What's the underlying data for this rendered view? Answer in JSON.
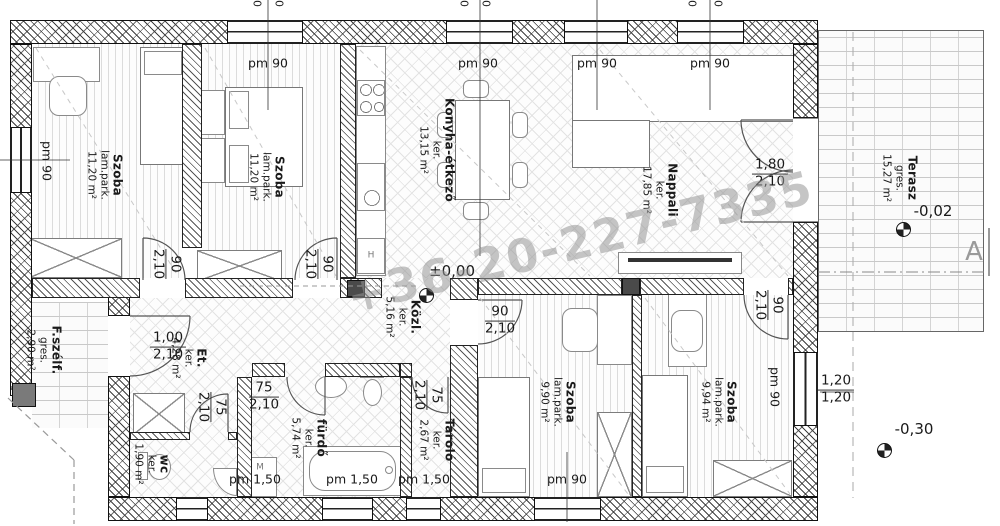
{
  "watermark": "+36-20-227-7335",
  "section": {
    "label": "A"
  },
  "levels": {
    "interior": "±0,00",
    "terrace": "-0,02",
    "garden": "-0,30"
  },
  "rooms": [
    {
      "name": "Szoba",
      "material": "lam.park.",
      "area": "11,20 m²"
    },
    {
      "name": "Szoba",
      "material": "lam.park.",
      "area": "11,20 m²"
    },
    {
      "name": "Konyha-étkező",
      "material": "ker.",
      "area": "13,15 m²"
    },
    {
      "name": "Nappali",
      "material": "ker.",
      "area": "17,85 m²"
    },
    {
      "name": "Terasz",
      "material": "gres.",
      "area": "15,27 m²"
    },
    {
      "name": "F.szélf.",
      "material": "gres.",
      "area": "2,90 m²"
    },
    {
      "name": "Et.",
      "material": "ker.",
      "area": "4,28 m²"
    },
    {
      "name": "Közl.",
      "material": "ker.",
      "area": "5,16 m²"
    },
    {
      "name": "wc",
      "material": "ker.",
      "area": "1,90 m²"
    },
    {
      "name": "fürdő",
      "material": "ker.",
      "area": "5,74 m²"
    },
    {
      "name": "Tároló",
      "material": "ker.",
      "area": "2,67 m²"
    },
    {
      "name": "Szoba",
      "material": "lam.park.",
      "area": "9,90 m²"
    },
    {
      "name": "Szoba",
      "material": "lam.park.",
      "area": "9,94 m²"
    }
  ],
  "doors": {
    "szoba1": {
      "w": "90",
      "h": "2,10"
    },
    "szoba2": {
      "w": "90",
      "h": "2,10"
    },
    "entry": {
      "w": "1,00",
      "h": "2,10"
    },
    "terrace": {
      "w": "1,80",
      "h": "2,10"
    },
    "wc": {
      "w": "75",
      "h": "2,10"
    },
    "furdo": {
      "w": "75",
      "h": "2,10"
    },
    "tarolo": {
      "w": "75",
      "h": "2,10"
    },
    "szoba3": {
      "w": "90",
      "h": "2,10"
    },
    "szoba4": {
      "w": "90",
      "h": "2,10"
    }
  },
  "windows": {
    "left": "pm 90",
    "top1": "pm 90",
    "top2": "pm 90",
    "top3": "pm 90",
    "top4": "pm 90",
    "right": "pm 90",
    "bottom_szoba": "pm 90",
    "wc": "pm 1,50",
    "furdo": "pm 1,50",
    "tarolo": "pm 1,50",
    "right_size_w": "1,20",
    "right_size_h": "1,20"
  },
  "appliances": {
    "fridge": "H",
    "washer": "M"
  },
  "partial_dims": [
    "0",
    "0",
    "0",
    "0",
    "0",
    "0"
  ]
}
